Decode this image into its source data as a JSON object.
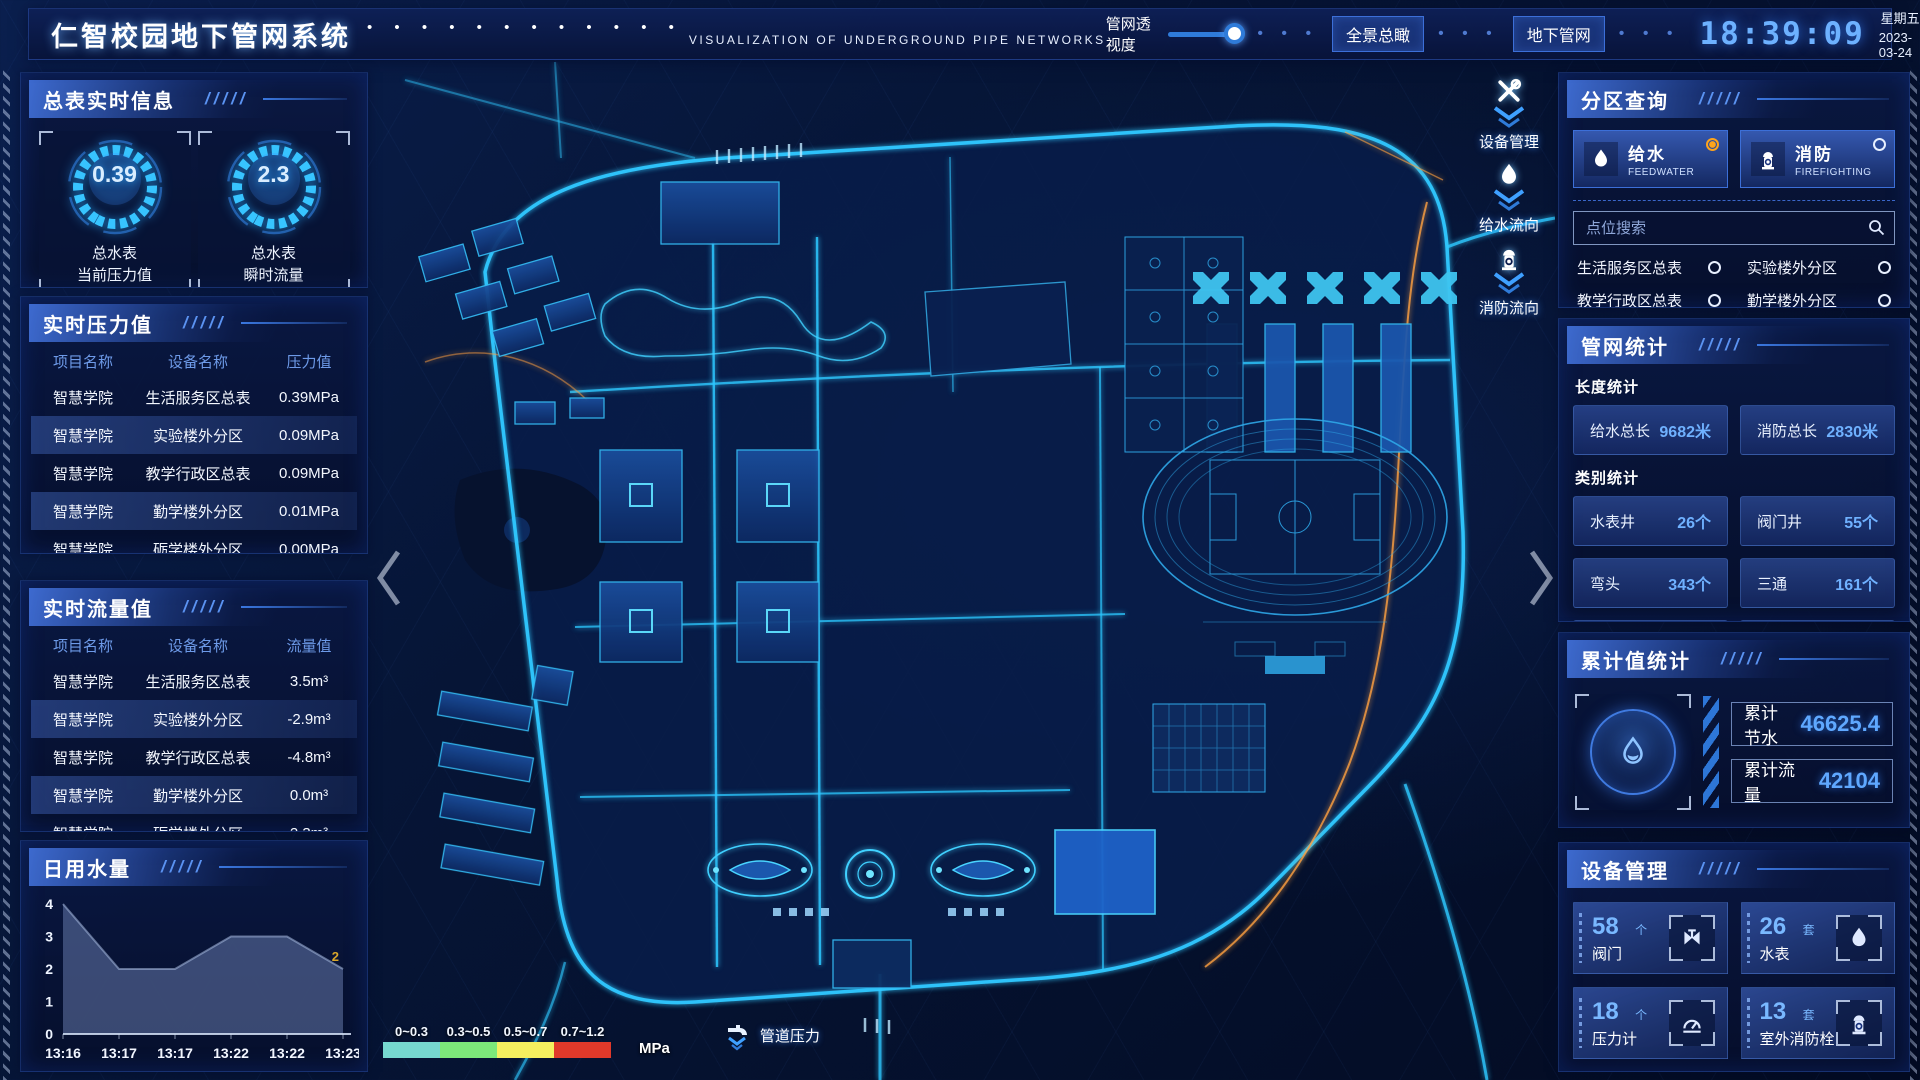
{
  "header": {
    "title": "仁智校园地下管网系统",
    "title_dots": "• • • • • • • • • • • •",
    "subtitle": "VISUALIZATION OF UNDERGROUND PIPE NETWORKS",
    "opacity_label": "管网透视度",
    "dot_sep": "• • •",
    "nav_buttons": [
      {
        "label": "全景总瞰"
      },
      {
        "label": "地下管网"
      }
    ],
    "time": "18:39:09",
    "weekday": "星期五",
    "date": "2023-03-24"
  },
  "left": {
    "meter_info": {
      "title": "总表实时信息",
      "gauges": [
        {
          "value": "0.39",
          "line1": "总水表",
          "line2": "当前压力值"
        },
        {
          "value": "2.3",
          "line1": "总水表",
          "line2": "瞬时流量"
        }
      ]
    },
    "pressure": {
      "title": "实时压力值",
      "headers": [
        "项目名称",
        "设备名称",
        "压力值"
      ],
      "rows": [
        {
          "project": "智慧学院",
          "device": "生活服务区总表",
          "value": "0.39MPa"
        },
        {
          "project": "智慧学院",
          "device": "实验楼外分区",
          "value": "0.09MPa"
        },
        {
          "project": "智慧学院",
          "device": "教学行政区总表",
          "value": "0.09MPa"
        },
        {
          "project": "智慧学院",
          "device": "勤学楼外分区",
          "value": "0.01MPa"
        },
        {
          "project": "智慧学院",
          "device": "砺学楼外分区",
          "value": "0.00MPa"
        }
      ]
    },
    "flow": {
      "title": "实时流量值",
      "headers": [
        "项目名称",
        "设备名称",
        "流量值"
      ],
      "rows": [
        {
          "project": "智慧学院",
          "device": "生活服务区总表",
          "value": "3.5m³"
        },
        {
          "project": "智慧学院",
          "device": "实验楼外分区",
          "value": "-2.9m³"
        },
        {
          "project": "智慧学院",
          "device": "教学行政区总表",
          "value": "-4.8m³"
        },
        {
          "project": "智慧学院",
          "device": "勤学楼外分区",
          "value": "0.0m³"
        },
        {
          "project": "智慧学院",
          "device": "砺学楼外分区",
          "value": "2.3m³"
        }
      ]
    },
    "daily_water": {
      "title": "日用水量",
      "chart_data": {
        "type": "area",
        "x": [
          "13:16",
          "13:17",
          "13:17",
          "13:22",
          "13:22",
          "13:23"
        ],
        "values": [
          4,
          2,
          2,
          3,
          3,
          2
        ],
        "yticks": [
          0,
          1,
          2,
          3,
          4
        ],
        "ylim": [
          0,
          4
        ],
        "end_label": "2",
        "end_label_color": "#d8a62a",
        "area_color": "rgba(128,152,205,0.42)",
        "line_color": "rgba(170,190,225,0.55)"
      }
    }
  },
  "right": {
    "zone_query": {
      "title": "分区查询",
      "tabs": [
        {
          "label": "给水",
          "sub": "FEEDWATER",
          "selected": true
        },
        {
          "label": "消防",
          "sub": "FIREFIGHTING",
          "selected": false
        }
      ],
      "search_placeholder": "点位搜索",
      "items": [
        "生活服务区总表",
        "实验楼外分区",
        "教学行政区总表",
        "勤学楼外分区",
        "砺学楼外分区",
        "宿舍区泵房"
      ]
    },
    "pipe_stats": {
      "title": "管网统计",
      "length_label": "长度统计",
      "length_items": [
        {
          "name": "给水总长",
          "value": "9682米"
        },
        {
          "name": "消防总长",
          "value": "2830米"
        }
      ],
      "category_label": "类别统计",
      "category_items": [
        {
          "name": "水表井",
          "value": "26个"
        },
        {
          "name": "阀门井",
          "value": "55个"
        },
        {
          "name": "弯头",
          "value": "343个"
        },
        {
          "name": "三通",
          "value": "161个"
        }
      ]
    },
    "cumulative": {
      "title": "累计值统计",
      "rows": [
        {
          "label": "累计节水",
          "value": "46625.4"
        },
        {
          "label": "累计流量",
          "value": "42104"
        }
      ]
    },
    "devices": {
      "title": "设备管理",
      "cards": [
        {
          "count": "58",
          "unit": "个",
          "label": "阀门"
        },
        {
          "count": "26",
          "unit": "套",
          "label": "水表"
        },
        {
          "count": "18",
          "unit": "个",
          "label": "压力计"
        },
        {
          "count": "13",
          "unit": "套",
          "label": "室外消防栓"
        }
      ]
    }
  },
  "map": {
    "overlay_buttons": [
      {
        "label": "设备管理"
      },
      {
        "label": "给水流向"
      },
      {
        "label": "消防流向"
      }
    ],
    "legend": {
      "ranges": [
        {
          "label": "0~0.3",
          "color": "#76d8cf"
        },
        {
          "label": "0.3~0.5",
          "color": "#7ce87a"
        },
        {
          "label": "0.5~0.7",
          "color": "#f4ef5f"
        },
        {
          "label": "0.7~1.2",
          "color": "#e0392a"
        }
      ],
      "unit": "MPa",
      "pressure_label": "管道压力"
    }
  },
  "colors": {
    "accent": "#2f6fe0",
    "cyan": "#2ec8ff",
    "value_blue": "#6fb1ff",
    "selected_orange": "#ffa41b"
  }
}
